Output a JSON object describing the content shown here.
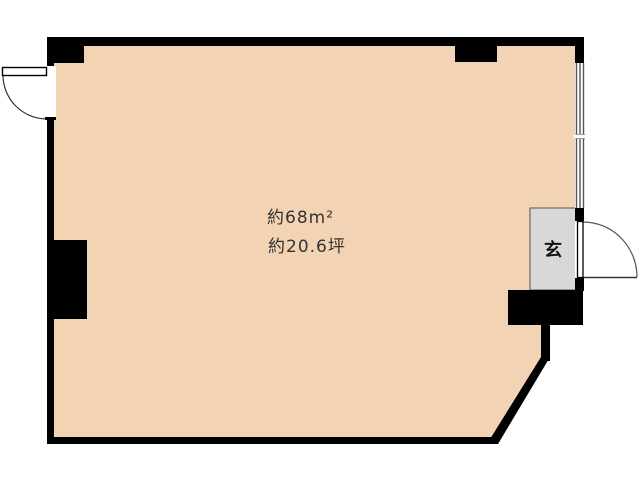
{
  "floor_plan": {
    "labels": {
      "area_m2": "約68m²",
      "area_tsubo": "約20.6坪",
      "entrance": "玄"
    },
    "colors": {
      "background": "#ffffff",
      "floor": "#F2D3B4",
      "wall": "#000000",
      "entrance_fill": "#D8D8D8",
      "entrance_border": "#555555",
      "window_line": "#555555",
      "door_line": "#333333",
      "label_text": "#333333"
    }
  }
}
